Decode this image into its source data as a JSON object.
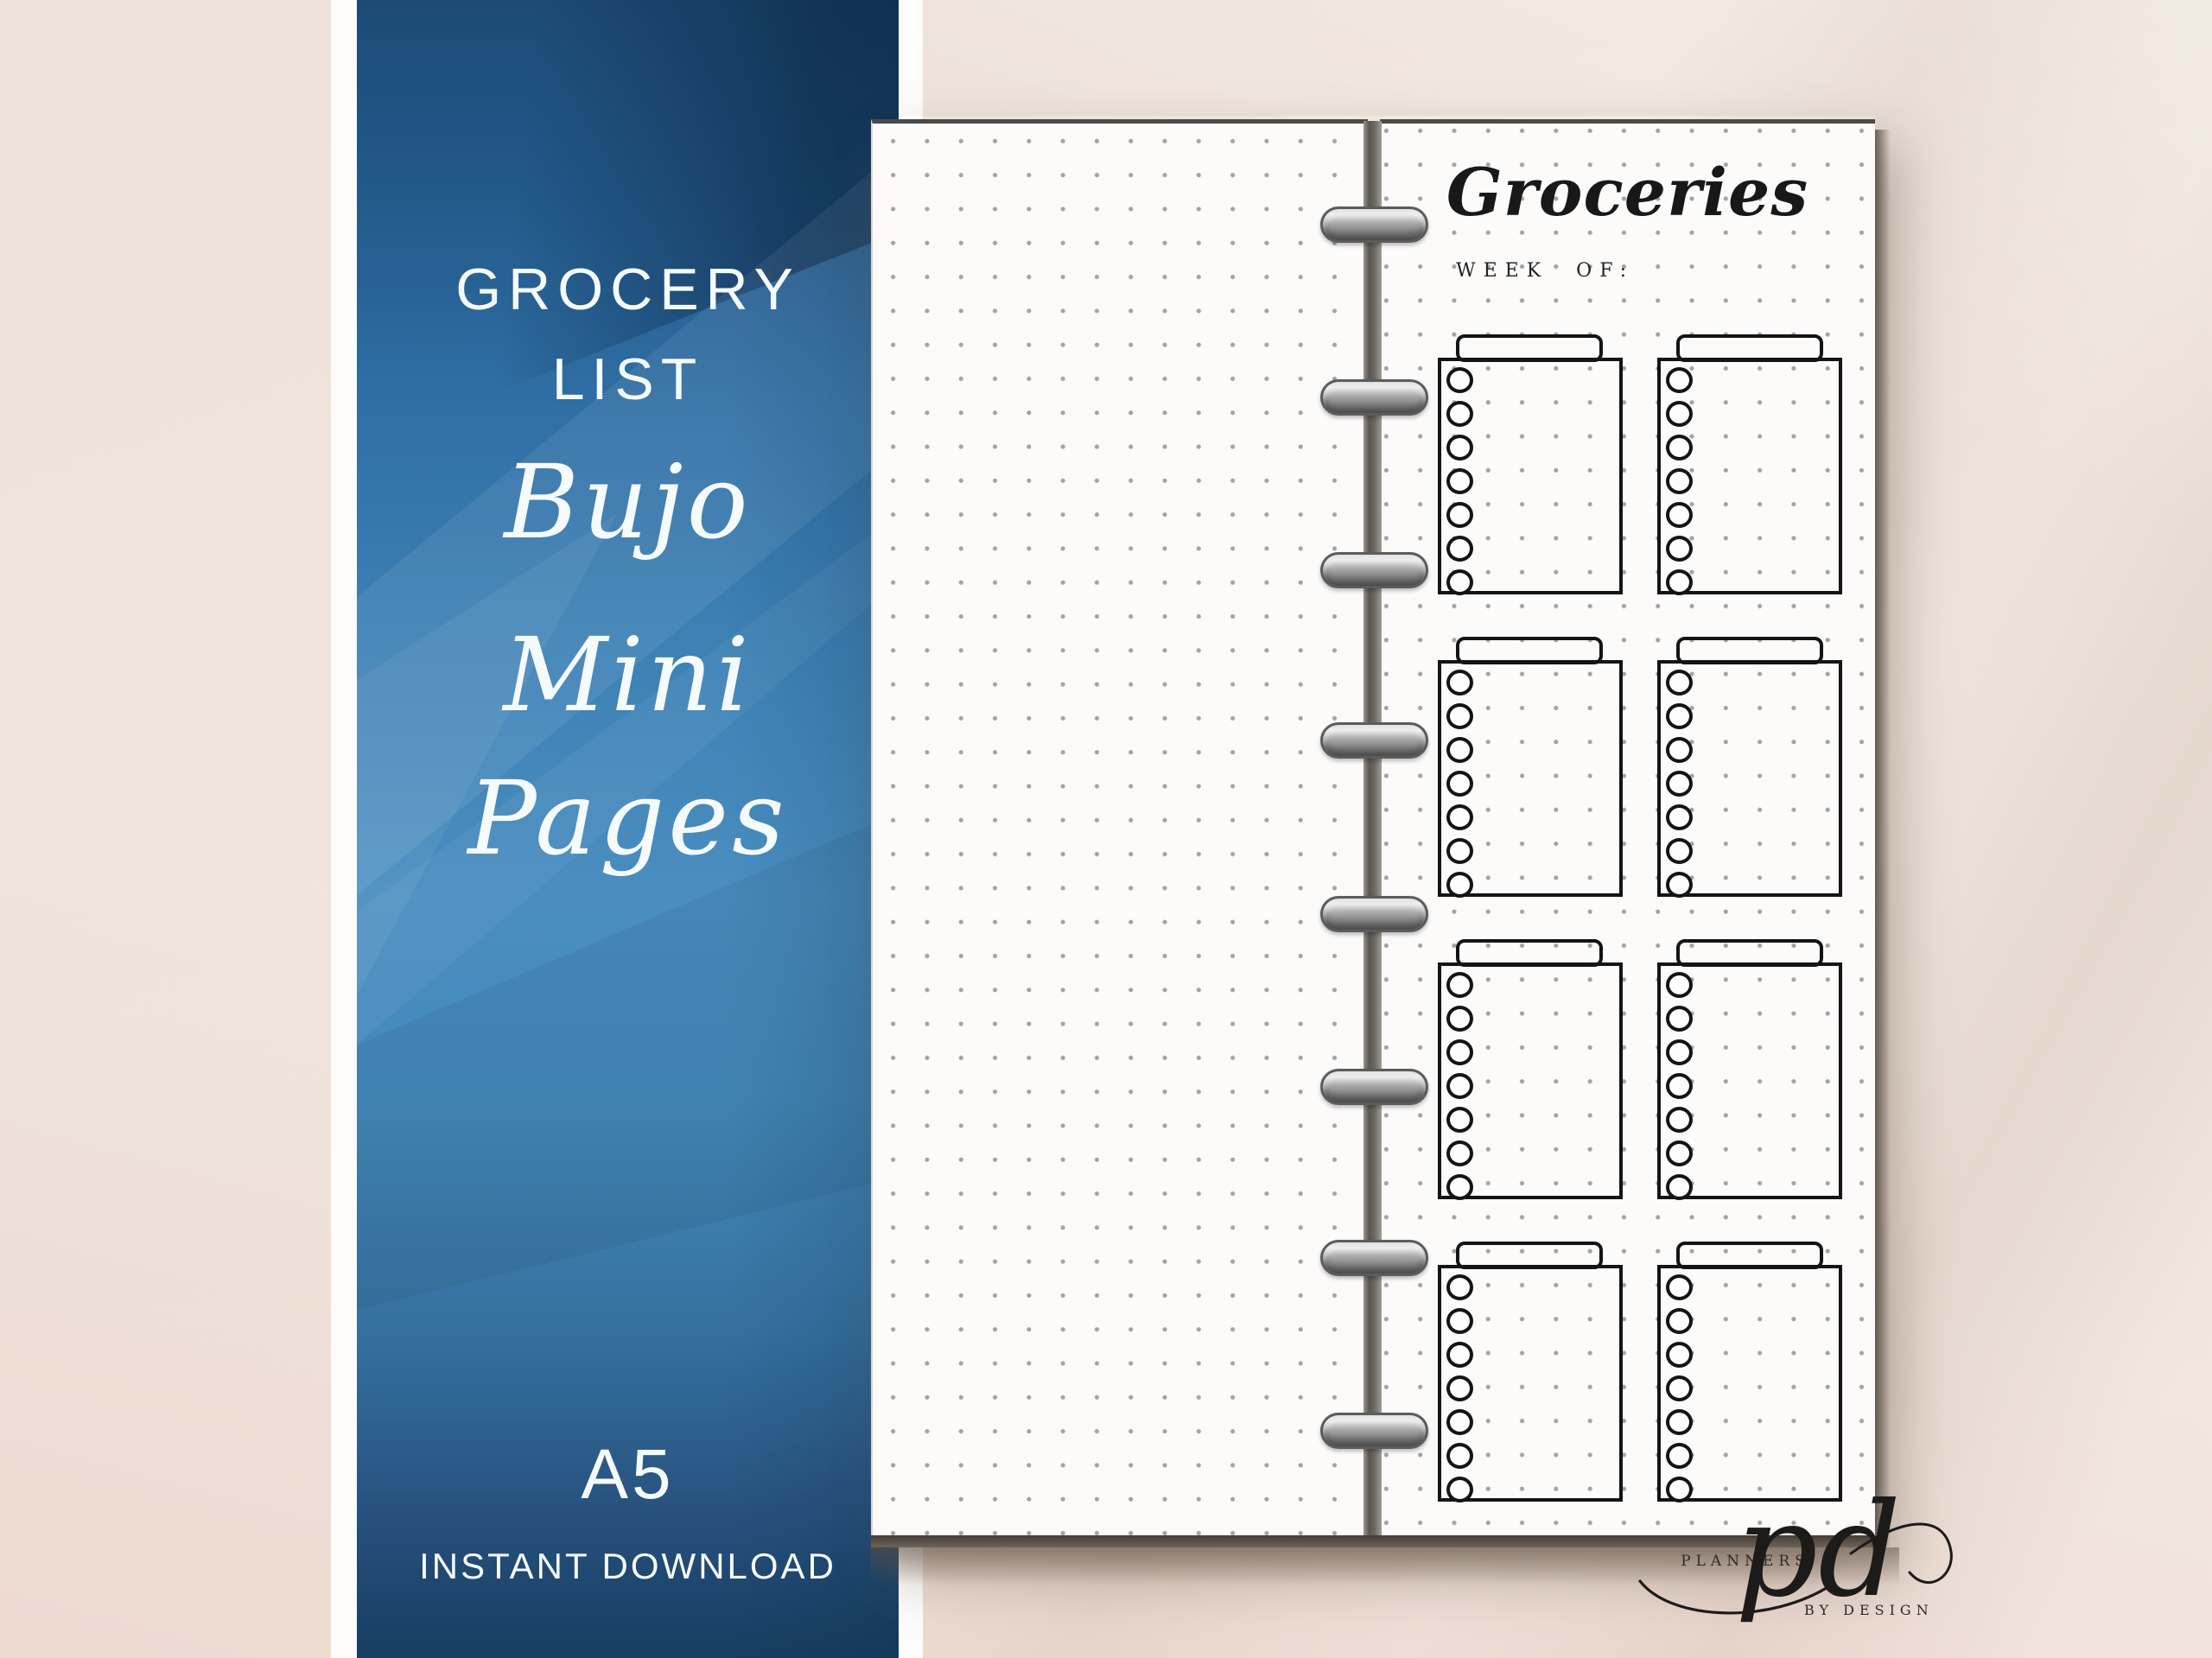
{
  "banner": {
    "heading_line1": "GROCERY",
    "heading_line2": "LIST",
    "script_lines": [
      "Bujo",
      "Mini",
      "Pages"
    ],
    "size_label": "A5",
    "availability_label": "INSTANT DOWNLOAD",
    "text_color": "#f5fafd",
    "blue_top": "#1c4a75",
    "blue_mid": "#4a8ec0",
    "blue_bottom": "#173d61"
  },
  "planner": {
    "disc_count": 8,
    "disc_color": "#9a9a9a",
    "left_page": {
      "content": "blank dot grid"
    },
    "right_page": {
      "title": "Groceries",
      "week_of_label": "WEEK OF:",
      "category_box_count": 8,
      "checkboxes_per_box": 7,
      "grid_rows": 4,
      "grid_cols": 2
    },
    "page_color": "#fcfbfa",
    "dot_color": "#a3a3a3"
  },
  "logo": {
    "brand_top": "PLANNERS",
    "monogram": "pd",
    "brand_bottom": "BY DESIGN"
  },
  "background_color": "#efe6de"
}
